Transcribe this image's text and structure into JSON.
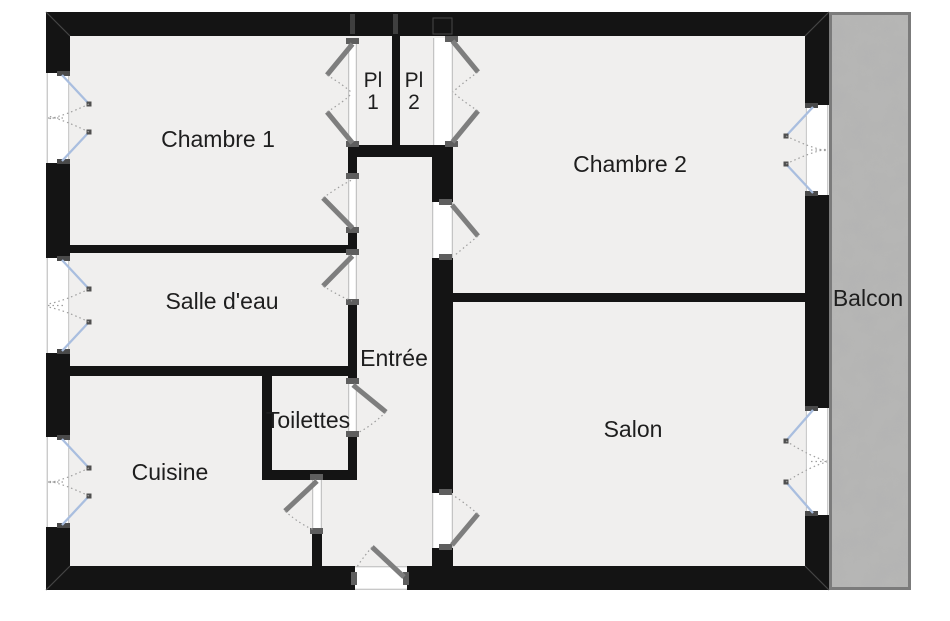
{
  "plan": {
    "rooms": {
      "chambre1": {
        "label": "Chambre 1"
      },
      "chambre2": {
        "label": "Chambre 2"
      },
      "salle_deau": {
        "label": "Salle d'eau"
      },
      "cuisine": {
        "label": "Cuisine"
      },
      "toilettes": {
        "label": "Toilettes"
      },
      "entree": {
        "label": "Entrée"
      },
      "salon": {
        "label": "Salon"
      },
      "balcon": {
        "label": "Balcon"
      },
      "placard1": {
        "line1": "Pl",
        "line2": "1"
      },
      "placard2": {
        "line1": "Pl",
        "line2": "2"
      }
    },
    "colors": {
      "wall": "#141414",
      "floor": "#f0efee",
      "outside": "#ffffff",
      "door": "#7e7e7e",
      "window-leaf": "#a9bedf",
      "swing-arc": "#9e9e9e",
      "balcony": "#b7b7b6",
      "balcony-border": "#7b7b7b",
      "label-text": "#1e1e1e"
    }
  }
}
